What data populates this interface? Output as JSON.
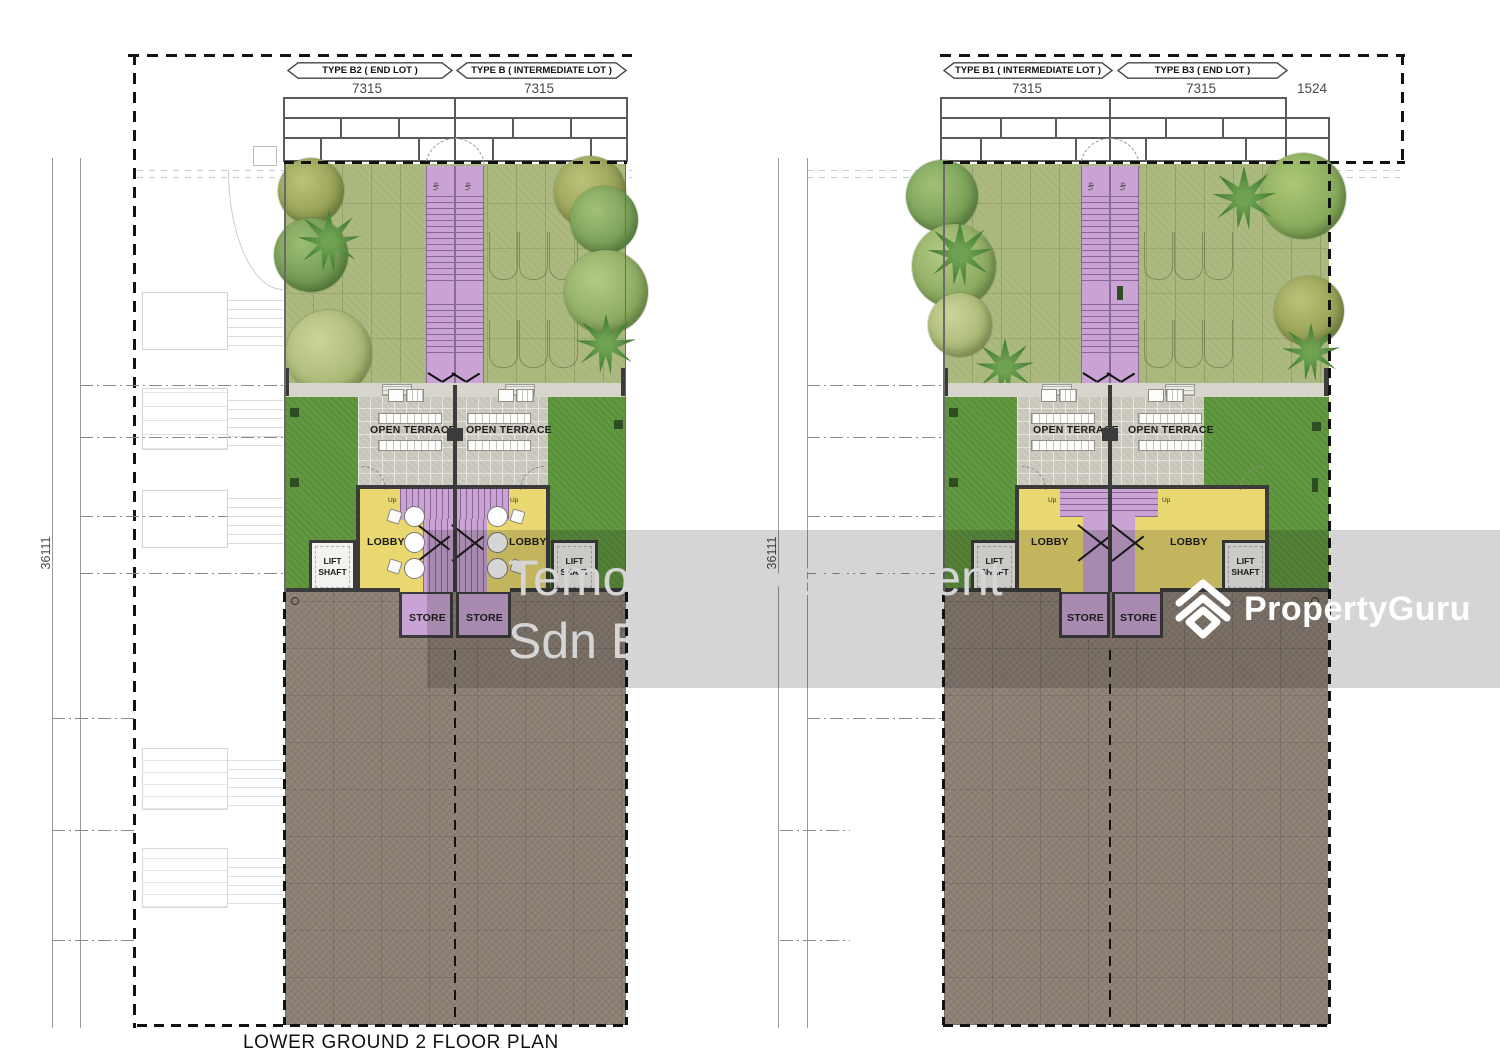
{
  "title": "LOWER GROUND 2 FLOOR PLAN",
  "plans": {
    "left": {
      "types": [
        "TYPE B2 ( END LOT )",
        "TYPE B ( INTERMEDIATE LOT )"
      ],
      "dims": [
        "7315",
        "7315"
      ],
      "side_dim": "36111"
    },
    "right": {
      "types": [
        "TYPE B1 ( INTERMEDIATE LOT )",
        "TYPE B3 ( END LOT )"
      ],
      "dims": [
        "7315",
        "7315",
        "1524"
      ],
      "side_dim": "36111"
    }
  },
  "rooms": {
    "open_terrace": "OPEN TERRACE",
    "lobby": "LOBBY",
    "lift_shaft": "LIFT SHAFT",
    "store": "STORE",
    "up": "Up"
  },
  "watermark": {
    "line1": "Temokin Development",
    "line2": "Sdn Bhd",
    "brand": "PropertyGuru"
  },
  "colors": {
    "lawn_light": "#a9b67c",
    "lawn_dark": "#619940",
    "terrace_gray": "#cdcac0",
    "lobby_yellow": "#e9d76f",
    "stair_purple": "#c9a3d3",
    "driveway_brown": "#8d8175",
    "wall_dark": "#3b3b3b",
    "watermark_white": "#ffffff"
  }
}
